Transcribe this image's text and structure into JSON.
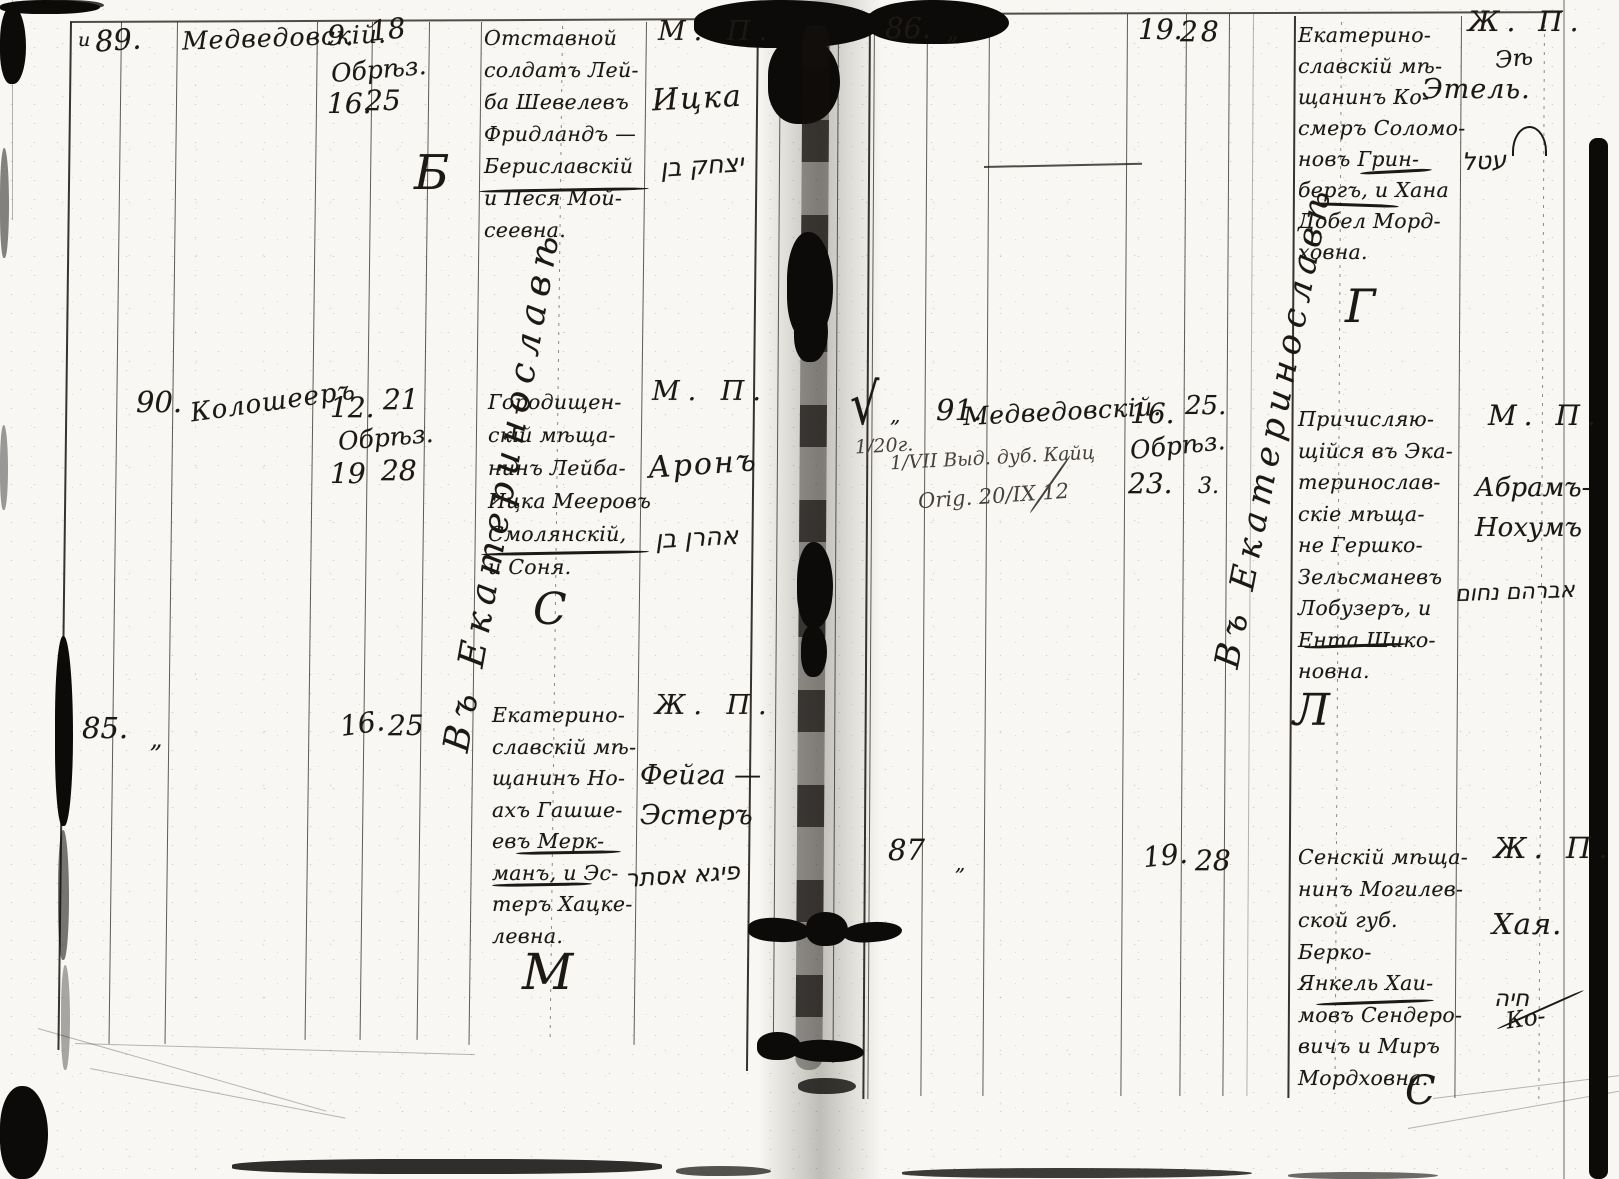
{
  "palette": {
    "paper": "#f8f7f3",
    "ink": "#1c1915",
    "pencil": "#46413b",
    "stain": "#0d0b09"
  },
  "left_page": {
    "diagonal_annotation": "Въ Екатеринославѣ",
    "e89": {
      "margin_mark": "и",
      "number": "89.",
      "surname": "Медведовскій.",
      "birth_day_julian": "9.",
      "birth_day_gregorian": "18",
      "event_label": "Обрѣз.",
      "event_day_julian": "16.",
      "event_day_gregorian": "25",
      "parents": [
        "Отставной",
        "солдатъ Лей-",
        "ба Шевелевъ",
        "Фридландъ —",
        "Бериславскій",
        "и Песя Мой-",
        "сеевна."
      ],
      "clerk_letter": "Б",
      "sex_mark": "М. П.",
      "child_name": "Ицка",
      "hebrew_note": "יצחק בן"
    },
    "e90": {
      "number": "90.",
      "surname": "Колошееръ",
      "birth_day_julian": "12.",
      "birth_day_gregorian": "21",
      "event_label": "Обрѣз.",
      "event_day_julian": "19",
      "event_day_gregorian": "28",
      "parents": [
        "Городищен-",
        "скій мѣща-",
        "нинъ Лейба-",
        "Ицка Мееровъ",
        "Смолянскій,",
        "и Соня."
      ],
      "clerk_letter": "С",
      "sex_mark": "М. П.",
      "child_name": "Аронъ",
      "hebrew_note": "אהרן בן"
    },
    "e85": {
      "number": "85.",
      "ditto_mark": "„",
      "event_day_julian": "16.",
      "event_day_gregorian": "25",
      "parents": [
        "Екатерино-",
        "славскій мѣ-",
        "щанинъ Но-",
        "ахъ Гашше-",
        "евъ Мерк-",
        "манъ, и Эс-",
        "теръ Хацке-",
        "левна."
      ],
      "clerk_letter": "М",
      "sex_mark": "Ж. П.",
      "child_name": [
        "Фейга —",
        "Эстеръ"
      ],
      "hebrew_note": "פיגא אסתר"
    }
  },
  "right_page": {
    "diagonal_annotation": "Въ Екатеринославѣ",
    "e86": {
      "number": "86.",
      "ditto_mark": "„",
      "event_day_julian": "19.",
      "event_day_gregorian": "28",
      "parents": [
        "Екатерино-",
        "славскій мѣ-",
        "щанинъ Ко-",
        "смеръ Соломо-",
        "новъ Грин-",
        "бергъ, и Хана",
        "Добел Морд-",
        "ховна."
      ],
      "clerk_letter": "Г",
      "sex_mark": "Ж. П.",
      "name_scribble": "Эѣ",
      "child_name": "Этель.",
      "hebrew_note": "עטל"
    },
    "e91": {
      "check_mark": "√",
      "ditto_mark": "„",
      "pencil_note_1": "1/20г.",
      "pencil_note_2": "1/VII Выд. дуб. Кайц",
      "pencil_note_3": "Orig. 20/IX 12",
      "number": "91.",
      "surname": "Медведовскій.",
      "birth_day_julian": "16.",
      "birth_day_gregorian": "25.",
      "event_label": "Обрѣз.",
      "event_day_julian": "23.",
      "event_day_gregorian": "3.",
      "parents": [
        "Причисляю-",
        "щійся въ Эка-",
        "теринослав-",
        "скіе мѣща-",
        "не Гершко-",
        "Зельсманевъ",
        "Лобузеръ, и",
        "Ента Шико-",
        "новна."
      ],
      "clerk_letter": "Л",
      "sex_mark": "М. П.",
      "child_name": [
        "Абрамъ-",
        "Нохумъ"
      ],
      "hebrew_note": "אברהם נחום"
    },
    "e87": {
      "number": "87",
      "ditto_mark": "„",
      "event_day_julian": "19.",
      "event_day_gregorian": "28",
      "parents": [
        "Сенскій мѣща-",
        "нинъ Могилев-",
        "ской губ. Берко-",
        "Янкель Хаи-",
        "мовъ Сендеро-",
        "вичъ и Миръ",
        "Мордховна."
      ],
      "clerk_letter": "С",
      "sex_mark": "Ж. П.",
      "child_name": "Хая.",
      "hebrew_note": "חיה",
      "name_suffix": "Ко-"
    }
  }
}
